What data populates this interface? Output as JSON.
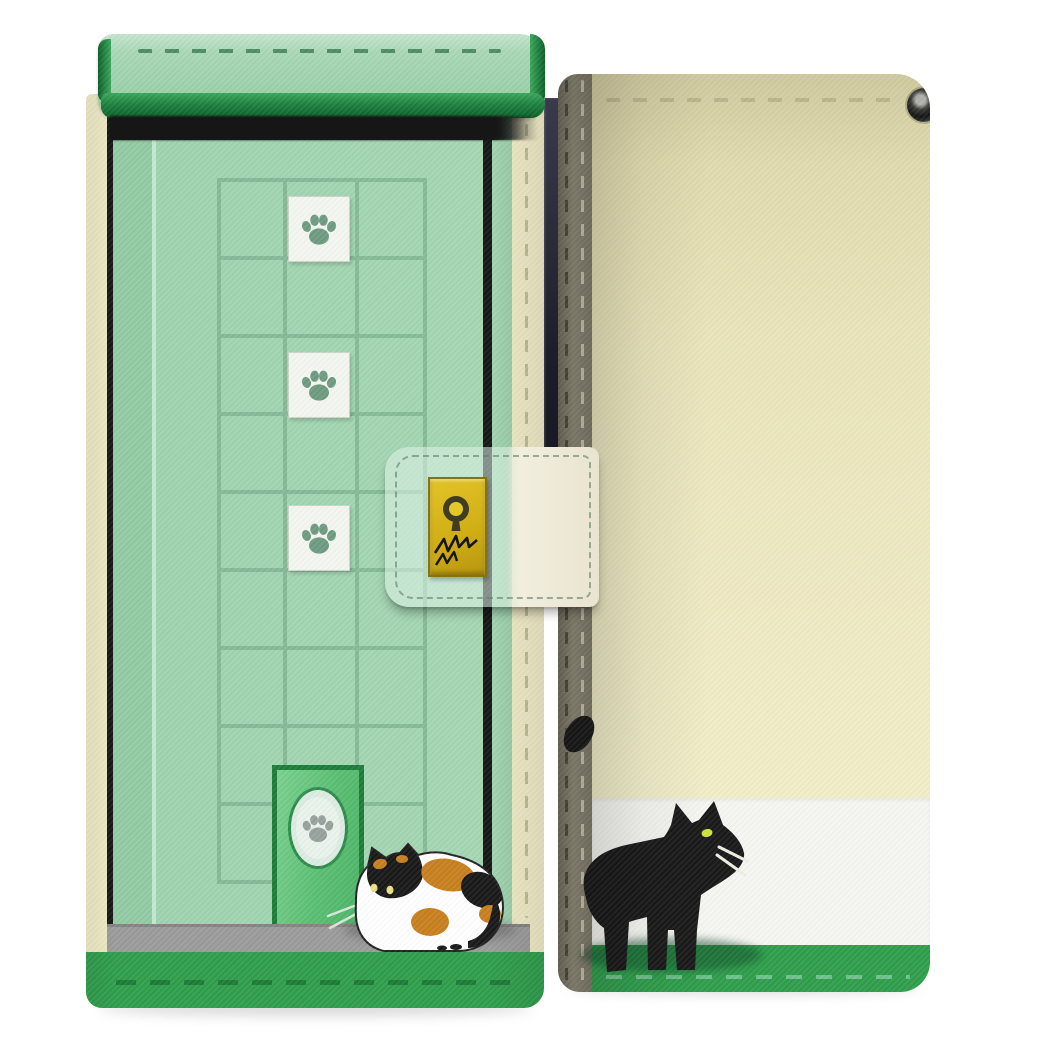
{
  "image": {
    "type_label": "product-photo",
    "subject_label": "flip-wallet-smartphone-case-front-and-back-views"
  },
  "labels": {
    "stage": "Product photo of a flip wallet smartphone case shown from front and back",
    "front_view": "Front cover with mint-green cat door artwork",
    "back_view": "Back cover in cream with black cat artwork",
    "flap": "Green top flap with stitched trim",
    "flap_shadow": "Shadow under top flap",
    "door_panel": "Mint green door with recessed panel grid",
    "paw_tile": "White tile with paw print",
    "paw_icon": "paw-print-icon",
    "cat_door": "Green cat door with paw print medallion",
    "calico_cat": "Calico cat crouching by the cat door",
    "floor": "Gray floor strip",
    "base_stripe": "Green base stripe with stitching",
    "strap": "Clasp strap crossing the cover",
    "lock": "Gold lock plate with keyhole and claw scratches",
    "keyhole": "keyhole-icon",
    "scratches": "claw-scratch-marks",
    "phone_edge": "Phone edge visible in the spine gap",
    "spine": "Stitched spine of the case",
    "camera_eyelet": "Camera eyelet hole",
    "black_cat": "Black cat walking along the back cover",
    "tail_tip": "Black cat tail tip behind the spine",
    "black_cat_shadow": "Cat shadow on green stripe",
    "ground_shadow": "Soft ground shadow under case"
  },
  "counts": {
    "views": 2,
    "paw_tiles": 3,
    "door_grid_rows": 9,
    "door_grid_columns": 3,
    "cats": 2
  },
  "colors": {
    "page_bg": "#ffffff",
    "ink": "#161616",
    "flap_green": "#a9d8b6",
    "flap_green_light": "#c4e5cd",
    "flap_trim_light": "#3aa75b",
    "flap_trim_dark": "#0c5f28",
    "flap_stitch": "#4d8d64",
    "door_green": "#9ed3ae",
    "door_grid": "#83b795",
    "door_frame": "#92cba3",
    "frame_highlight": "#c6e7d1",
    "cover_cream": "#f0ebc6",
    "cream_stitch": "#c3bc93",
    "tile_bg": "#f4f6f0",
    "tile_border": "#ccd6c8",
    "paw_glyph": "#6f9b82",
    "catdoor_border": "#1d7c39",
    "catdoor_fill_a": "#7bd18f",
    "catdoor_fill_b": "#4db468",
    "catdoor_ring": "#dcede2",
    "catdoor_disc": "#eaf3ec",
    "catdoor_paw": "#97a29e",
    "floor_gray": "#9b9b9b",
    "floor_edge": "#848484",
    "base_green": "#2f9e4c",
    "base_stitch_dark": "#1e7a39",
    "base_stitch_light": "#6fc28c",
    "beige_top": "#dcd6a8",
    "beige_mid": "#eae5bb",
    "beige_low": "#f2eec9",
    "band_white": "#f6f6f2",
    "spine_dark": "#6f6b5b",
    "spine_mid": "#8f8a77",
    "spine_low": "#7f7a69",
    "spine_stitch_dark": "#4e4a3c",
    "spine_stitch_light": "#cbc5ae",
    "phone_dark_a": "#3a3a4c",
    "phone_dark_b": "#1c1c28",
    "strap_tint": "rgba(222,242,230,0.55)",
    "strap_white": "#f2eede",
    "strap_white_low": "#e9e4cf",
    "strap_stitch": "rgba(95,125,105,0.6)",
    "lock_gold_a": "#e2c428",
    "lock_gold_b": "#b8960f",
    "lock_border": "#857312",
    "lock_ink": "#3f3e22",
    "lock_center": "#e3c82a",
    "cat_black": "#191919",
    "cat_eye": "#cfe23f",
    "whisker": "#eef0e2",
    "calico_orange": "#c8801f",
    "calico_eye": "#ece284",
    "calico_whisker": "#d8e7da",
    "ground_shadow": "rgba(0,0,0,0.15)",
    "black_cat_shadow": "rgba(13,72,38,0.5)",
    "calico_shadow": "rgba(75,75,75,0.35)"
  }
}
